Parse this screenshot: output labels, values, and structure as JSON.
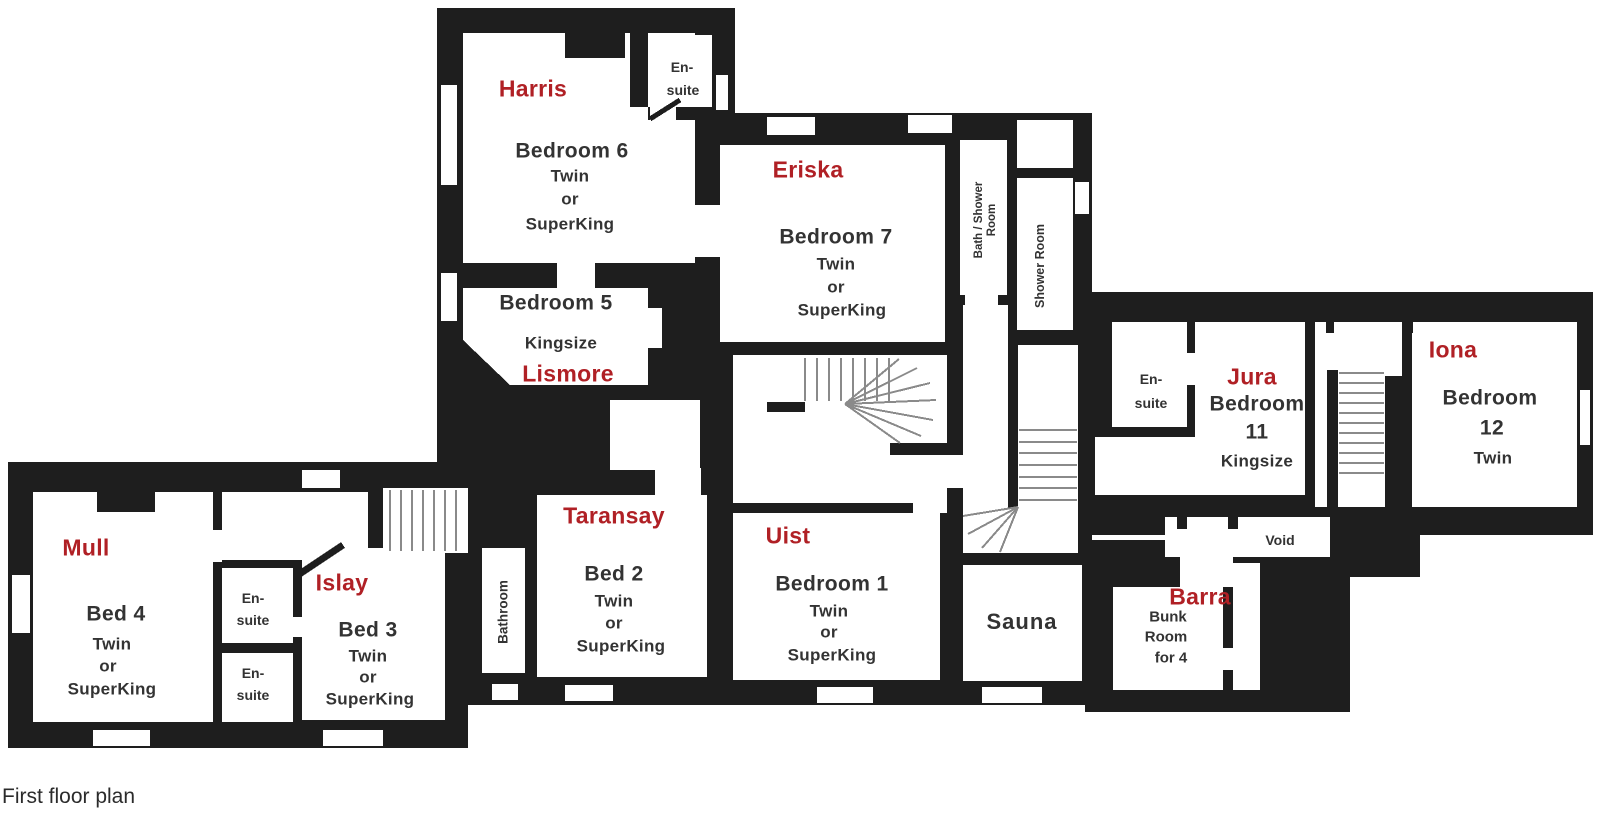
{
  "title": "First floor plan drawing",
  "caption": "First floor plan",
  "colors": {
    "wall": "#1e1e1e",
    "room_name_red": "#b02025",
    "plan_text": "#333333",
    "stair_line": "#8a8a8a",
    "background": "#ffffff"
  },
  "labels": {
    "harris": "Harris",
    "eriska": "Eriska",
    "lismore": "Lismore",
    "jura": "Jura",
    "iona": "Iona",
    "mull": "Mull",
    "islay": "Islay",
    "taransay": "Taransay",
    "uist": "Uist",
    "barra": "Barra",
    "bedroom6": "Bedroom 6",
    "bedroom7": "Bedroom 7",
    "bedroom5": "Bedroom 5",
    "bedroom11": "Bedroom",
    "bedroom11_num": "11",
    "bedroom12": "Bedroom",
    "bedroom12_num": "12",
    "bedroom1": "Bedroom 1",
    "bed2": "Bed 2",
    "bed3": "Bed 3",
    "bed4": "Bed 4",
    "twin": "Twin",
    "or": "or",
    "superking": "SuperKing",
    "kingsize": "Kingsize",
    "ensuite_l1": "En-",
    "ensuite_l2": "suite",
    "bath_shower_l1": "Bath / Shower",
    "bath_shower_l2": "Room",
    "shower_room": "Shower Room",
    "bathroom": "Bathroom",
    "sauna": "Sauna",
    "void": "Void",
    "bunk_l1": "Bunk",
    "bunk_l2": "Room",
    "bunk_l3": "for 4",
    "caption": "First floor plan"
  }
}
